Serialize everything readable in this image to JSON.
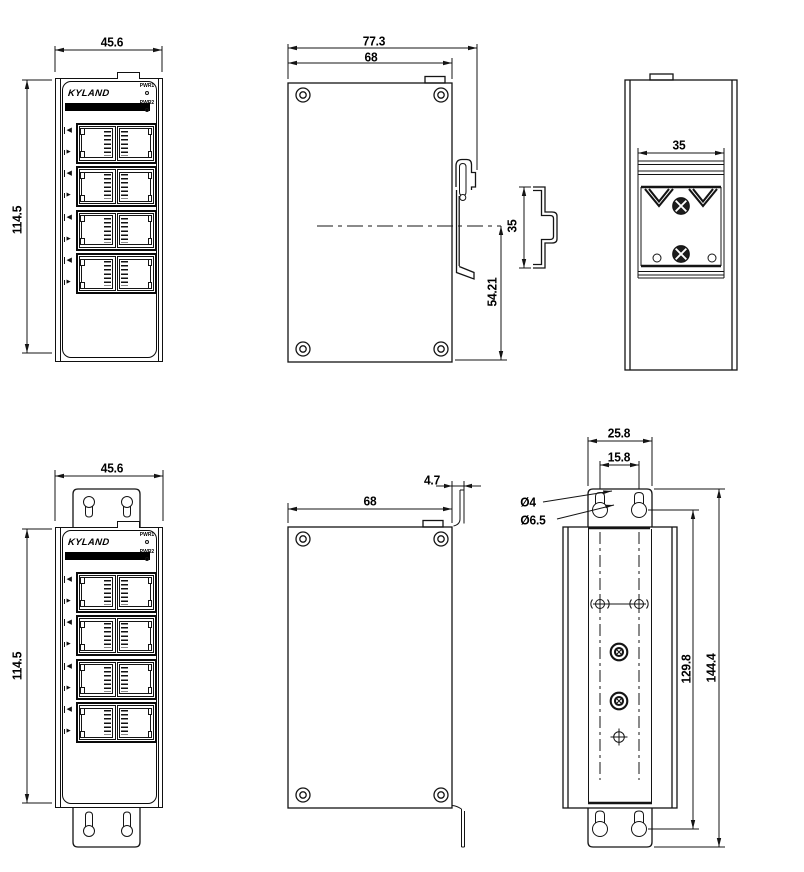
{
  "drawing_title": "Industrial Ethernet switch installation dimension drawing",
  "device": {
    "brand": "KYLAND",
    "led_labels": [
      "PWR1",
      "PWR2"
    ]
  },
  "icons": {
    "port_in": "◀",
    "port_out": "▶"
  },
  "colors": {
    "line": "#141414",
    "panel_bar": "#000000",
    "background": "#ffffff"
  },
  "dimensions": {
    "top_front": {
      "width": "45.6",
      "height": "114.5"
    },
    "top_side": {
      "total_depth": "77.3",
      "body_depth": "68",
      "rail_center_to_bottom": "54.21",
      "rail_profile_width": "35"
    },
    "top_rear": {
      "rail_width": "35"
    },
    "bottom_front": {
      "width": "45.6",
      "height": "114.5"
    },
    "bottom_side": {
      "body_depth": "68",
      "plate_offset": "4.7"
    },
    "bottom_rear": {
      "bracket_width": "25.8",
      "hole_spacing": "15.8",
      "slot_diameter": "Ø4",
      "hole_diameter": "Ø6.5",
      "hole_span": "129.8",
      "bracket_height": "144.4"
    }
  }
}
